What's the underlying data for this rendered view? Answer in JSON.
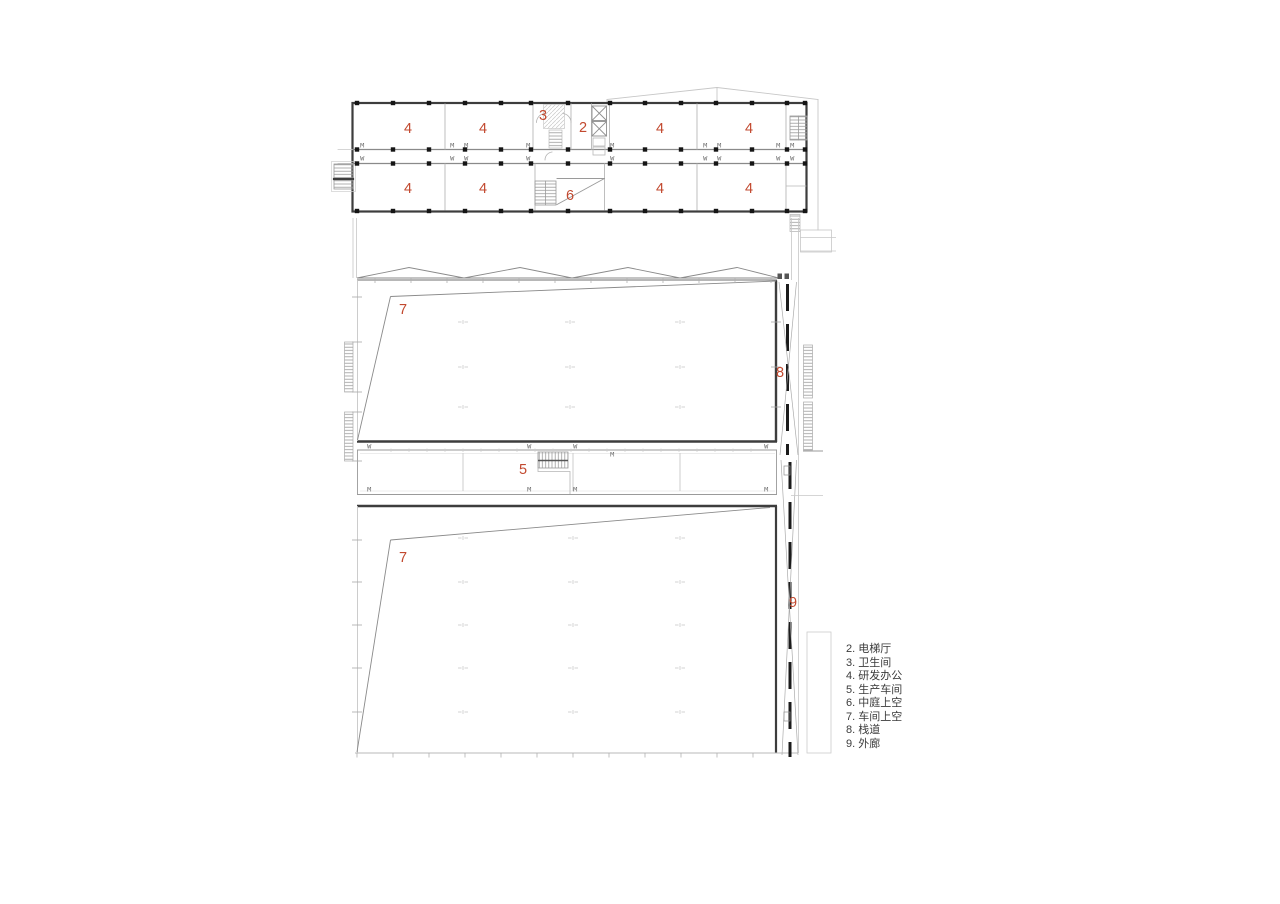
{
  "plan": {
    "label_color": "#c2492f",
    "room_labels": [
      {
        "text": "4",
        "x": 408,
        "y": 129
      },
      {
        "text": "4",
        "x": 483,
        "y": 129
      },
      {
        "text": "3",
        "x": 543,
        "y": 116
      },
      {
        "text": "2",
        "x": 583,
        "y": 128
      },
      {
        "text": "4",
        "x": 660,
        "y": 129
      },
      {
        "text": "4",
        "x": 749,
        "y": 129
      },
      {
        "text": "4",
        "x": 408,
        "y": 189
      },
      {
        "text": "4",
        "x": 483,
        "y": 189
      },
      {
        "text": "6",
        "x": 570,
        "y": 196
      },
      {
        "text": "4",
        "x": 660,
        "y": 189
      },
      {
        "text": "4",
        "x": 749,
        "y": 189
      },
      {
        "text": "7",
        "x": 403,
        "y": 310
      },
      {
        "text": "8",
        "x": 780,
        "y": 373
      },
      {
        "text": "5",
        "x": 523,
        "y": 470
      },
      {
        "text": "7",
        "x": 403,
        "y": 558
      },
      {
        "text": "9",
        "x": 793,
        "y": 603
      }
    ]
  },
  "legend": {
    "text_color": "#3b3b3b",
    "items": [
      "2. 电梯厅",
      "3. 卫生间",
      "4. 研发办公",
      "5. 生产车间",
      "6. 中庭上空",
      "7. 车间上空",
      "8. 栈道",
      "9. 外廊"
    ]
  }
}
